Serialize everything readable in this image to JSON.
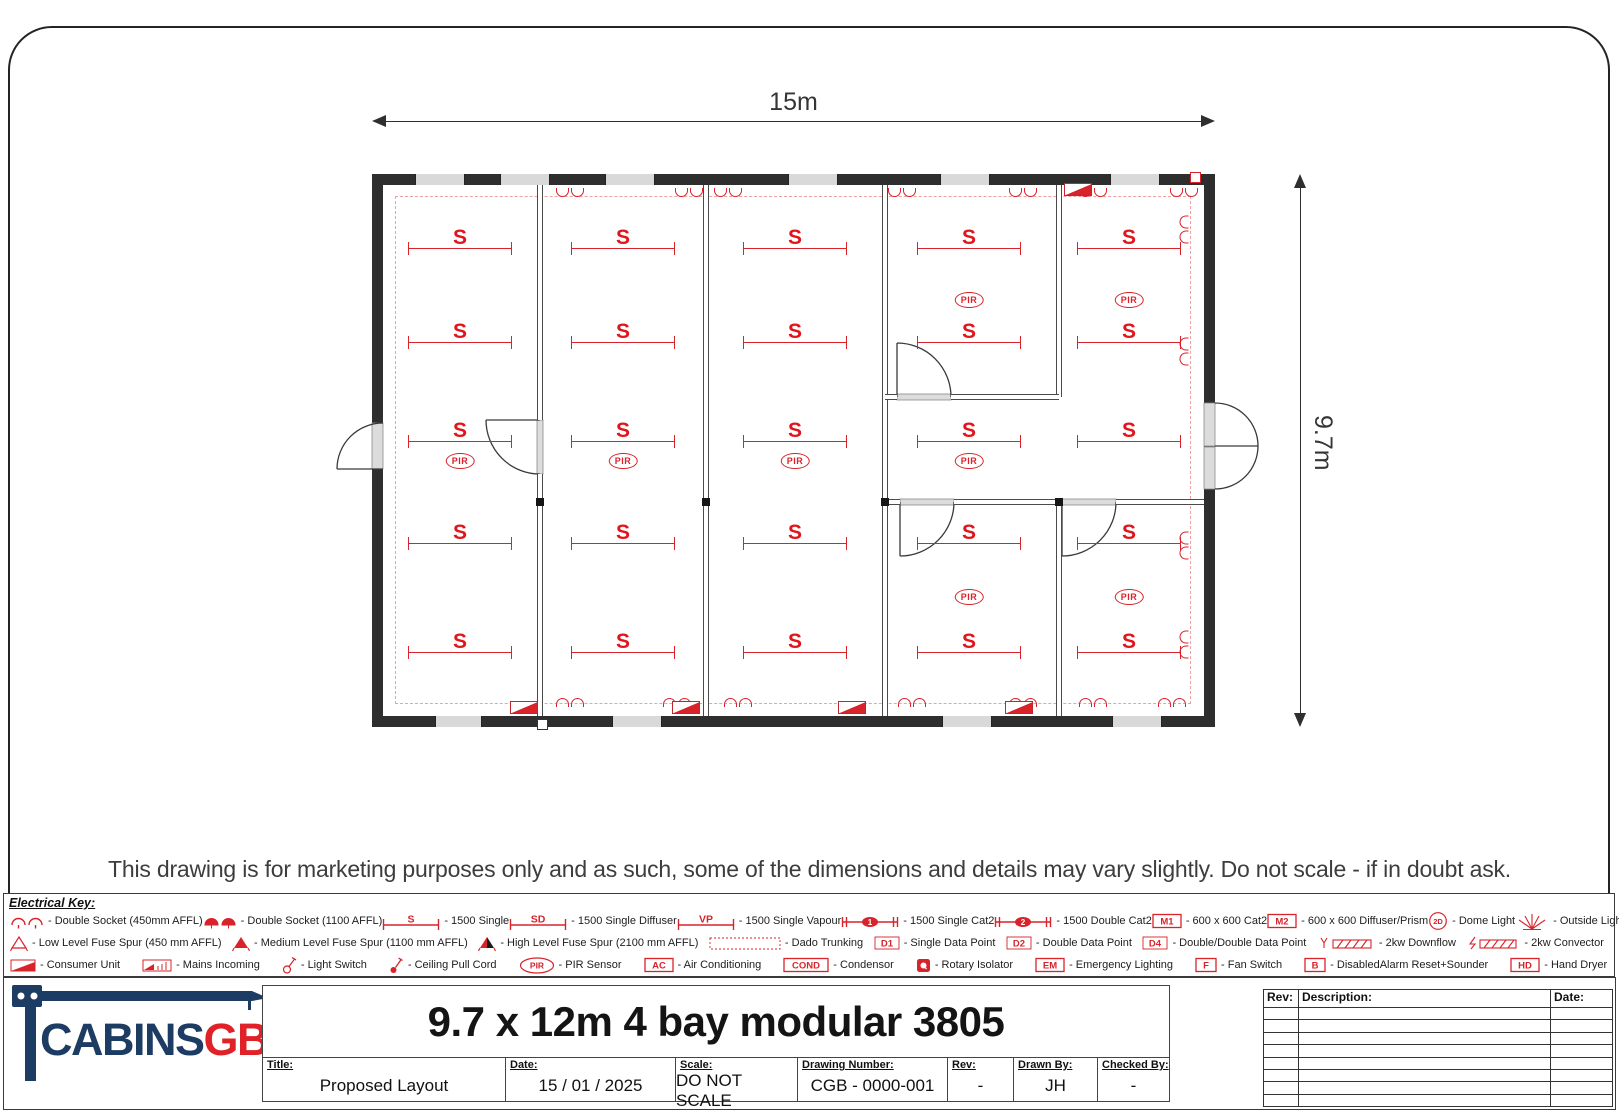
{
  "dimensions": {
    "width_label": "15m",
    "height_label": "9.7m"
  },
  "disclaimer": "This drawing is for marketing purposes only and as such, some of the dimensions and details may vary slightly. Do not scale - if in doubt ask.",
  "plan": {
    "s_label": "S",
    "pir_label": "PIR",
    "lights": [
      [
        77,
        63
      ],
      [
        77,
        157
      ],
      [
        77,
        256
      ],
      [
        77,
        358
      ],
      [
        77,
        467
      ],
      [
        240,
        63
      ],
      [
        240,
        157
      ],
      [
        240,
        256
      ],
      [
        240,
        358
      ],
      [
        240,
        467
      ],
      [
        412,
        63
      ],
      [
        412,
        157
      ],
      [
        412,
        256
      ],
      [
        412,
        358
      ],
      [
        412,
        467
      ],
      [
        586,
        63
      ],
      [
        586,
        157
      ],
      [
        586,
        256
      ],
      [
        586,
        358
      ],
      [
        586,
        467
      ],
      [
        746,
        63
      ],
      [
        746,
        157
      ],
      [
        746,
        256
      ],
      [
        746,
        358
      ],
      [
        746,
        467
      ]
    ],
    "pirs": [
      [
        77,
        276
      ],
      [
        240,
        276
      ],
      [
        412,
        276
      ],
      [
        586,
        276
      ],
      [
        586,
        115
      ],
      [
        746,
        115
      ],
      [
        586,
        412
      ],
      [
        746,
        412
      ]
    ],
    "sockets": {
      "top": [
        187,
        306,
        345,
        519,
        640,
        710,
        801
      ],
      "bottom": [
        187,
        294,
        355,
        529,
        640,
        710,
        789
      ],
      "right": [
        45,
        167,
        361,
        460
      ]
    },
    "windows": {
      "top": [
        [
          32,
          50
        ],
        [
          117,
          50
        ],
        [
          222,
          50
        ],
        [
          405,
          50
        ],
        [
          557,
          50
        ],
        [
          727,
          50
        ]
      ],
      "bottom": [
        [
          52,
          47
        ],
        [
          229,
          50
        ],
        [
          559,
          50
        ],
        [
          729,
          50
        ]
      ]
    },
    "walls_v": [
      {
        "x": 154,
        "y": 0,
        "h": 235
      },
      {
        "x": 154,
        "y": 289,
        "h": 242
      },
      {
        "x": 320,
        "y": 0,
        "h": 531
      },
      {
        "x": 499,
        "y": 0,
        "h": 531
      },
      {
        "x": 673,
        "y": 0,
        "h": 212
      },
      {
        "x": 673,
        "y": 317,
        "h": 214
      }
    ],
    "walls_h": [
      {
        "x": 502,
        "y": 209,
        "w": 12
      },
      {
        "x": 568,
        "y": 209,
        "w": 108
      },
      {
        "x": 502,
        "y": 314,
        "w": 15
      },
      {
        "x": 571,
        "y": 314,
        "w": 108
      },
      {
        "x": 733,
        "y": 314,
        "w": 88
      }
    ],
    "joint_squares": [
      [
        153,
        313
      ],
      [
        319,
        313
      ],
      [
        498,
        313
      ],
      [
        672,
        313
      ]
    ],
    "consumer_units": [
      [
        127,
        516
      ],
      [
        289,
        516
      ],
      [
        455,
        516
      ],
      [
        622,
        516
      ],
      [
        681,
        -2
      ]
    ],
    "red_squares": [
      [
        807,
        -13
      ]
    ],
    "white_squares": [
      [
        154,
        534
      ]
    ]
  },
  "key": {
    "title": "Electrical Key:",
    "rows": [
      [
        {
          "icon": "socket-outline",
          "label": "- Double Socket (450mm AFFL)"
        },
        {
          "icon": "socket-filled",
          "label": "- Double Socket (1100 AFFL)"
        },
        {
          "icon": "strip",
          "tag": "S",
          "label": "- 1500 Single"
        },
        {
          "icon": "strip",
          "tag": "SD",
          "label": "- 1500 Single Diffuser"
        },
        {
          "icon": "strip",
          "tag": "VP",
          "label": "- 1500 Single Vapour"
        },
        {
          "icon": "strip-oval",
          "tag": "1",
          "label": "- 1500 Single Cat2"
        },
        {
          "icon": "strip-oval",
          "tag": "2",
          "label": "- 1500 Double Cat2"
        },
        {
          "icon": "box",
          "tag": "M1",
          "label": "- 600 x 600 Cat2"
        },
        {
          "icon": "box",
          "tag": "M2",
          "label": "- 600 x 600 Diffuser/Prism"
        },
        {
          "icon": "ring",
          "tag": "2D",
          "label": "- Dome Light"
        },
        {
          "icon": "rays",
          "label": "- Outside Light"
        }
      ],
      [
        {
          "icon": "spur-outline",
          "label": "- Low Level Fuse Spur (450 mm AFFL)"
        },
        {
          "icon": "spur-filled",
          "label": "- Medium Level Fuse Spur (1100 mm AFFL)"
        },
        {
          "icon": "spur-dark",
          "label": "- High Level Fuse Spur (2100 mm AFFL)"
        },
        {
          "icon": "dado",
          "label": "- Dado Trunking"
        },
        {
          "icon": "dtag",
          "tag": "D1",
          "label": "- Single Data Point"
        },
        {
          "icon": "dtag",
          "tag": "D2",
          "label": "- Double Data Point"
        },
        {
          "icon": "dtag",
          "tag": "D4",
          "label": "- Double/Double Data Point"
        },
        {
          "icon": "downflow",
          "label": "- 2kw Downflow"
        },
        {
          "icon": "convector",
          "label": "- 2kw Convector"
        }
      ],
      [
        {
          "icon": "consumer",
          "label": "- Consumer Unit"
        },
        {
          "icon": "mains",
          "label": "- Mains Incoming"
        },
        {
          "icon": "switch",
          "label": "- Light Switch"
        },
        {
          "icon": "pullcord",
          "label": "- Ceiling Pull Cord"
        },
        {
          "icon": "pir",
          "tag": "PIR",
          "label": "- PIR Sensor"
        },
        {
          "icon": "box",
          "tag": "AC",
          "label": "- Air Conditioning"
        },
        {
          "icon": "box",
          "tag": "COND",
          "label": "- Condensor"
        },
        {
          "icon": "rotary",
          "label": "- Rotary Isolator"
        },
        {
          "icon": "box",
          "tag": "EM",
          "label": "- Emergency Lighting"
        },
        {
          "icon": "box",
          "tag": "F",
          "label": "- Fan Switch"
        },
        {
          "icon": "box",
          "tag": "B",
          "label": "- DisabledAlarm Reset+Sounder"
        },
        {
          "icon": "box",
          "tag": "HD",
          "label": "- Hand Dryer"
        },
        {
          "icon": "fan",
          "label": "- Extractor Fan"
        }
      ]
    ]
  },
  "title_block": {
    "logo": {
      "text_primary": "CABINS",
      "text_accent": "GB"
    },
    "title": "9.7 x 12m 4 bay modular 3805",
    "fields": [
      {
        "label": "Title:",
        "value": "Proposed Layout"
      },
      {
        "label": "Date:",
        "value": "15 / 01 / 2025"
      },
      {
        "label": "Scale:",
        "value": "DO NOT SCALE"
      },
      {
        "label": "Drawing Number:",
        "value": "CGB - 0000-001"
      },
      {
        "label": "Rev:",
        "value": "-"
      },
      {
        "label": "Drawn By:",
        "value": "JH"
      },
      {
        "label": "Checked By:",
        "value": "-"
      }
    ],
    "rev_table": {
      "headers": [
        "Rev:",
        "Description:",
        "Date:"
      ],
      "empty_rows": 8
    }
  },
  "colors": {
    "symbol_red": "#d8232a",
    "wall_black": "#2e2e2e",
    "logo_navy": "#1d3c63",
    "logo_red": "#e02127"
  }
}
